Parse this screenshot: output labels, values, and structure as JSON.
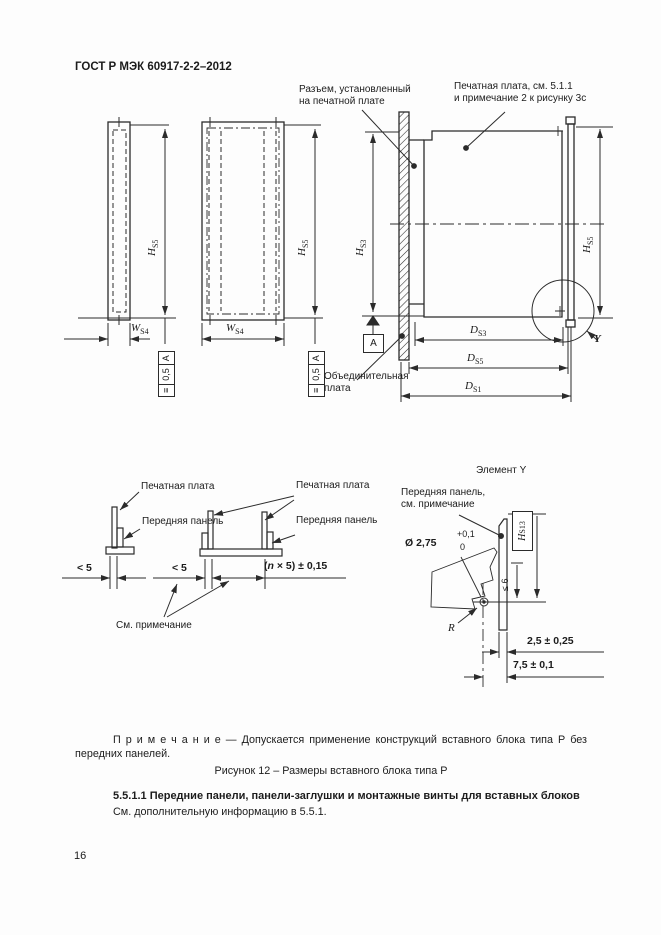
{
  "doc": {
    "header": "ГОСТ Р МЭК 60917-2-2–2012",
    "page_number": "16",
    "note": "П р и м е ч а н и е  —  Допускается применение конструкций вставного блока типа Р без передних панелей.",
    "caption": "Рисунок 12 – Размеры вставного блока типа Р",
    "heading": "5.5.1.1 Передние панели, панели-заглушки и монтажные винты для вставных блоков",
    "body_text": "См. дополнительную информацию в 5.5.1."
  },
  "fig": {
    "labels": {
      "connector": "Разъем, установленный\nна печатной плате",
      "pcb_note": "Печатная плата, см. 5.1.1\nи примечание 2 к рисунку 3с",
      "backplane": "Объединительная\nплата",
      "pcb": "Печатная плата",
      "front_panel": "Передняя панель",
      "see_note": "См. примечание",
      "element_y": "Элемент Y",
      "fp_see_note": "Передняя панель,\nсм. примечание"
    },
    "dims": {
      "hs5": {
        "b": "H",
        "s": "S5"
      },
      "hs3": {
        "b": "H",
        "s": "S3"
      },
      "ws4": {
        "b": "W",
        "s": "S4"
      },
      "ds3": {
        "b": "D",
        "s": "S3"
      },
      "ds5": {
        "b": "D",
        "s": "S5"
      },
      "ds1": {
        "b": "D",
        "s": "S1"
      },
      "hs13": {
        "b": "H",
        "s": "S13"
      },
      "le6": "≤ 6",
      "dia": "Ø 2,75",
      "tol_plus": "+0,1",
      "tol_zero": "0",
      "d25": "2,5 ± 0,25",
      "d75": "7,5 ± 0,1",
      "lt5": "< 5",
      "n5": {
        "pre": "(",
        "n": "n",
        "post": " × 5) ± 0,15"
      },
      "r": "R",
      "y": "Y",
      "datum": "A",
      "fcf": {
        "sym": "≡",
        "val": "0,5",
        "ref": "A"
      }
    }
  }
}
